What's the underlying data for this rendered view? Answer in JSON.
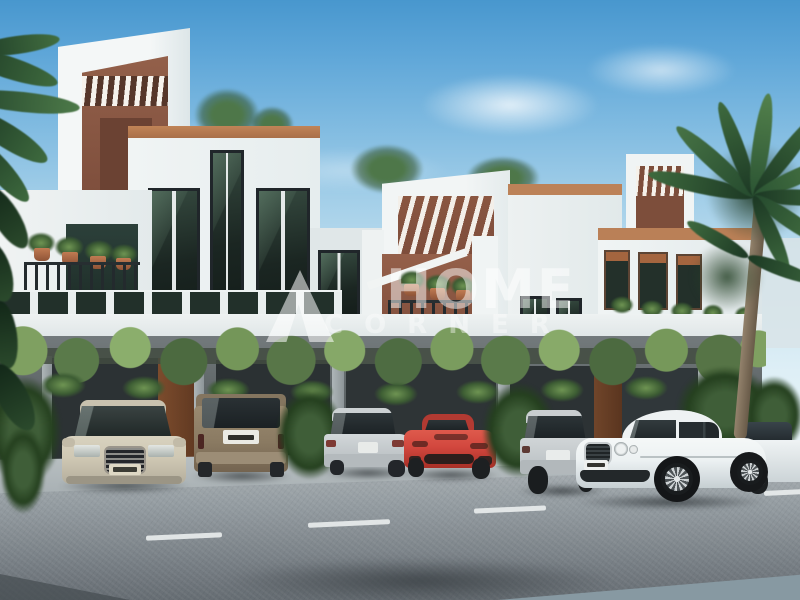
{
  "watermark": {
    "logo_icon": "mountain-a-logo",
    "title": "HOME",
    "subtitle": "CORNER"
  },
  "scene": {
    "type": "architectural-render-photo",
    "setting": "Row of modern white townhouses with terracotta accents, vine-covered carport level, palm trees, parked cars and a foreground asphalt road with dashed lane line",
    "palette": {
      "sky_top": "#4E9ED4",
      "sky_horizon": "#DCEEF5",
      "wall_white": "#EFF3F3",
      "accent_terracotta": "#B97F57",
      "wall_brown": "#86543F",
      "vines_green": "#6F8F55",
      "window_glass": "#1E2924",
      "road_gray": "#8F979C",
      "car_beige": "#CFC8B4",
      "car_bronze": "#8E7E66",
      "car_silver": "#C7CCCE",
      "car_red": "#D2473E",
      "car_white": "#EEF2F3"
    },
    "objects": [
      "beige-sedan-front",
      "bronze-suv-rear",
      "silver-coupe-rear",
      "red-sportscar-front",
      "silver-sedan-rear",
      "white-luxury-coupe",
      "white-sedan-partial",
      "palm-trees",
      "vine-trellis",
      "townhouse-row"
    ]
  }
}
